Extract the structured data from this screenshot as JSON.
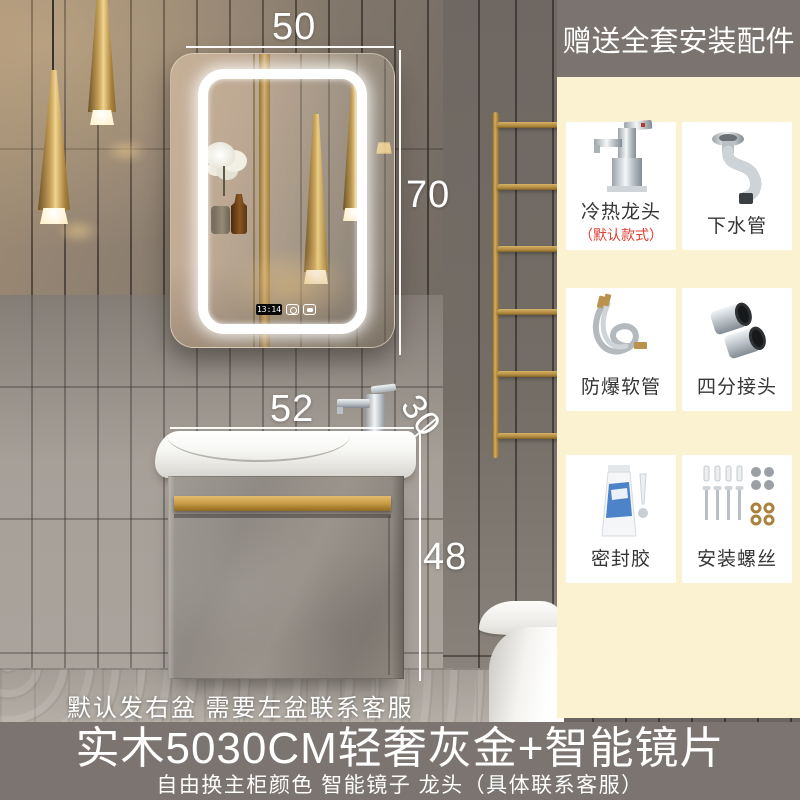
{
  "banner": {
    "text": "赠送全套安装配件"
  },
  "accessories": {
    "items": [
      {
        "label": "冷热龙头",
        "note": "（默认款式）",
        "icon": "faucet-icon"
      },
      {
        "label": "下水管",
        "icon": "drain-pipe-icon"
      },
      {
        "label": "防爆软管",
        "icon": "braided-hose-icon"
      },
      {
        "label": "四分接头",
        "icon": "pipe-adapter-icon"
      },
      {
        "label": "密封胶",
        "icon": "sealant-icon"
      },
      {
        "label": "安装螺丝",
        "icon": "screws-icon"
      }
    ]
  },
  "photo": {
    "dimensions": {
      "mirror_width_cm": "50",
      "mirror_height_cm": "70",
      "basin_width_cm": "52",
      "basin_depth_cm": "30",
      "cabinet_height_cm": "48"
    },
    "mirror_clock": "13:14",
    "note": "默认发右盆 需要左盆联系客服"
  },
  "footer": {
    "title": "实木5030CM轻奢灰金+智能镜片",
    "subtitle": "自由换主柜颜色 智能镜子 龙头（具体联系客服）"
  },
  "colors": {
    "banner_bg": "#7a736f",
    "panel_bg": "#fbf2d2",
    "note_red": "#e53b30",
    "gold": "#c9a050",
    "footer_bg": "#7b7471"
  }
}
